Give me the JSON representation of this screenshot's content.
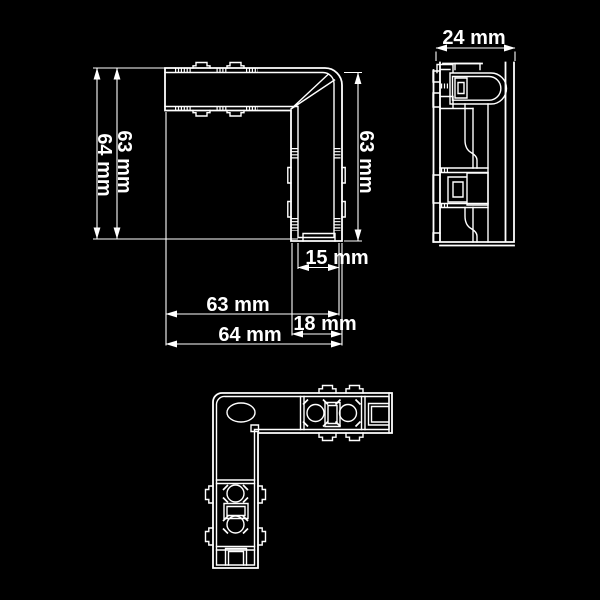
{
  "canvas": {
    "background": "#000000",
    "line_color": "#ffffff",
    "text_color": "#ffffff"
  },
  "drawing": {
    "type": "technical-dimension-drawing",
    "subject": "L-shaped corner connector profile, three orthographic views"
  },
  "views": {
    "front_view": {
      "dim_left_outer": "64 mm",
      "dim_left_inner": "63 mm",
      "dim_right": "63 mm",
      "dim_bottom_small": "15 mm",
      "dim_bottom_inner": "63 mm",
      "dim_bottom_step": "18 mm",
      "dim_bottom_outer": "64 mm"
    },
    "side_view": {
      "dim_width": "24 mm"
    },
    "bottom_view": {}
  }
}
